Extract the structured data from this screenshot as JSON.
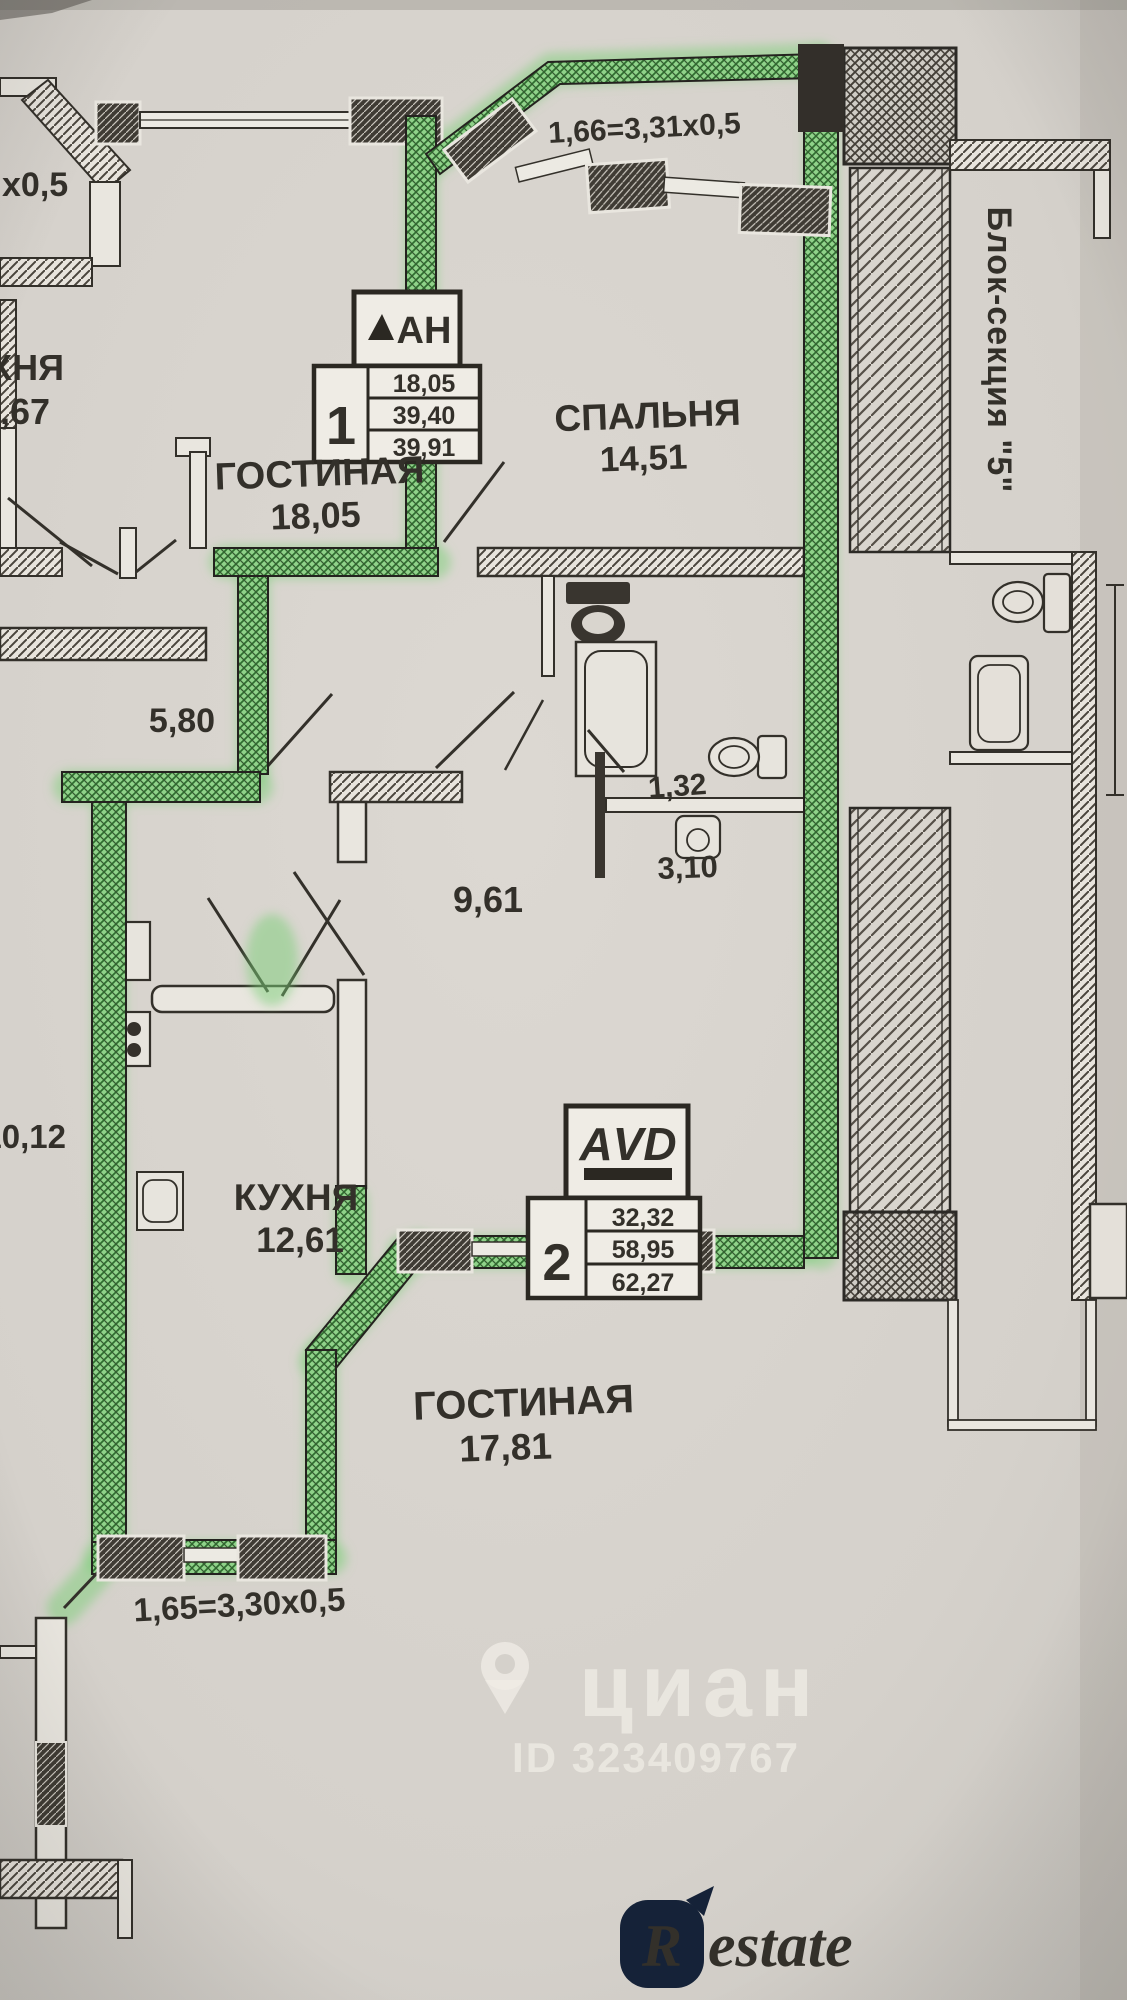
{
  "rooms": [
    {
      "name": "СПАЛЬНЯ",
      "area": "14,51"
    },
    {
      "name": "ГОСТИНАЯ",
      "area": "18,05"
    },
    {
      "name": "КУХНЯ",
      "area": "12,61"
    },
    {
      "name": "ГОСТИНАЯ",
      "area": "17,81"
    }
  ],
  "areas": {
    "hall": "9,61",
    "hallway": "5,80",
    "wc": "1,32",
    "bathroom": "3,10"
  },
  "clipped": {
    "room_name": "ХНЯ",
    "room_area": ",67",
    "left_area": "10,12",
    "top_left_dim": "х0,5"
  },
  "dimensions": {
    "top_balcony": "1,66=3,31х0,5",
    "bottom_balcony": "1,65=3,30х0,5"
  },
  "stamps": [
    {
      "logo": "АН",
      "number": "1",
      "rows": [
        "18,05",
        "39,40",
        "39,91"
      ]
    },
    {
      "logo": "АVD",
      "number": "2",
      "rows": [
        "32,32",
        "58,95",
        "62,27"
      ]
    }
  ],
  "annotations": {
    "block_section": "Блок-секция \"5\""
  },
  "watermark": {
    "brand": "циан",
    "listing_id": "ID 323409767"
  },
  "footer_logo": {
    "initial": "R",
    "rest": "estate"
  },
  "palette": {
    "paper": "#d6d2cc",
    "ink": "#33302a",
    "highlighter": "#7ccf78",
    "highlighter_dark": "#2e6d2f",
    "logo_navy": "#152238"
  }
}
